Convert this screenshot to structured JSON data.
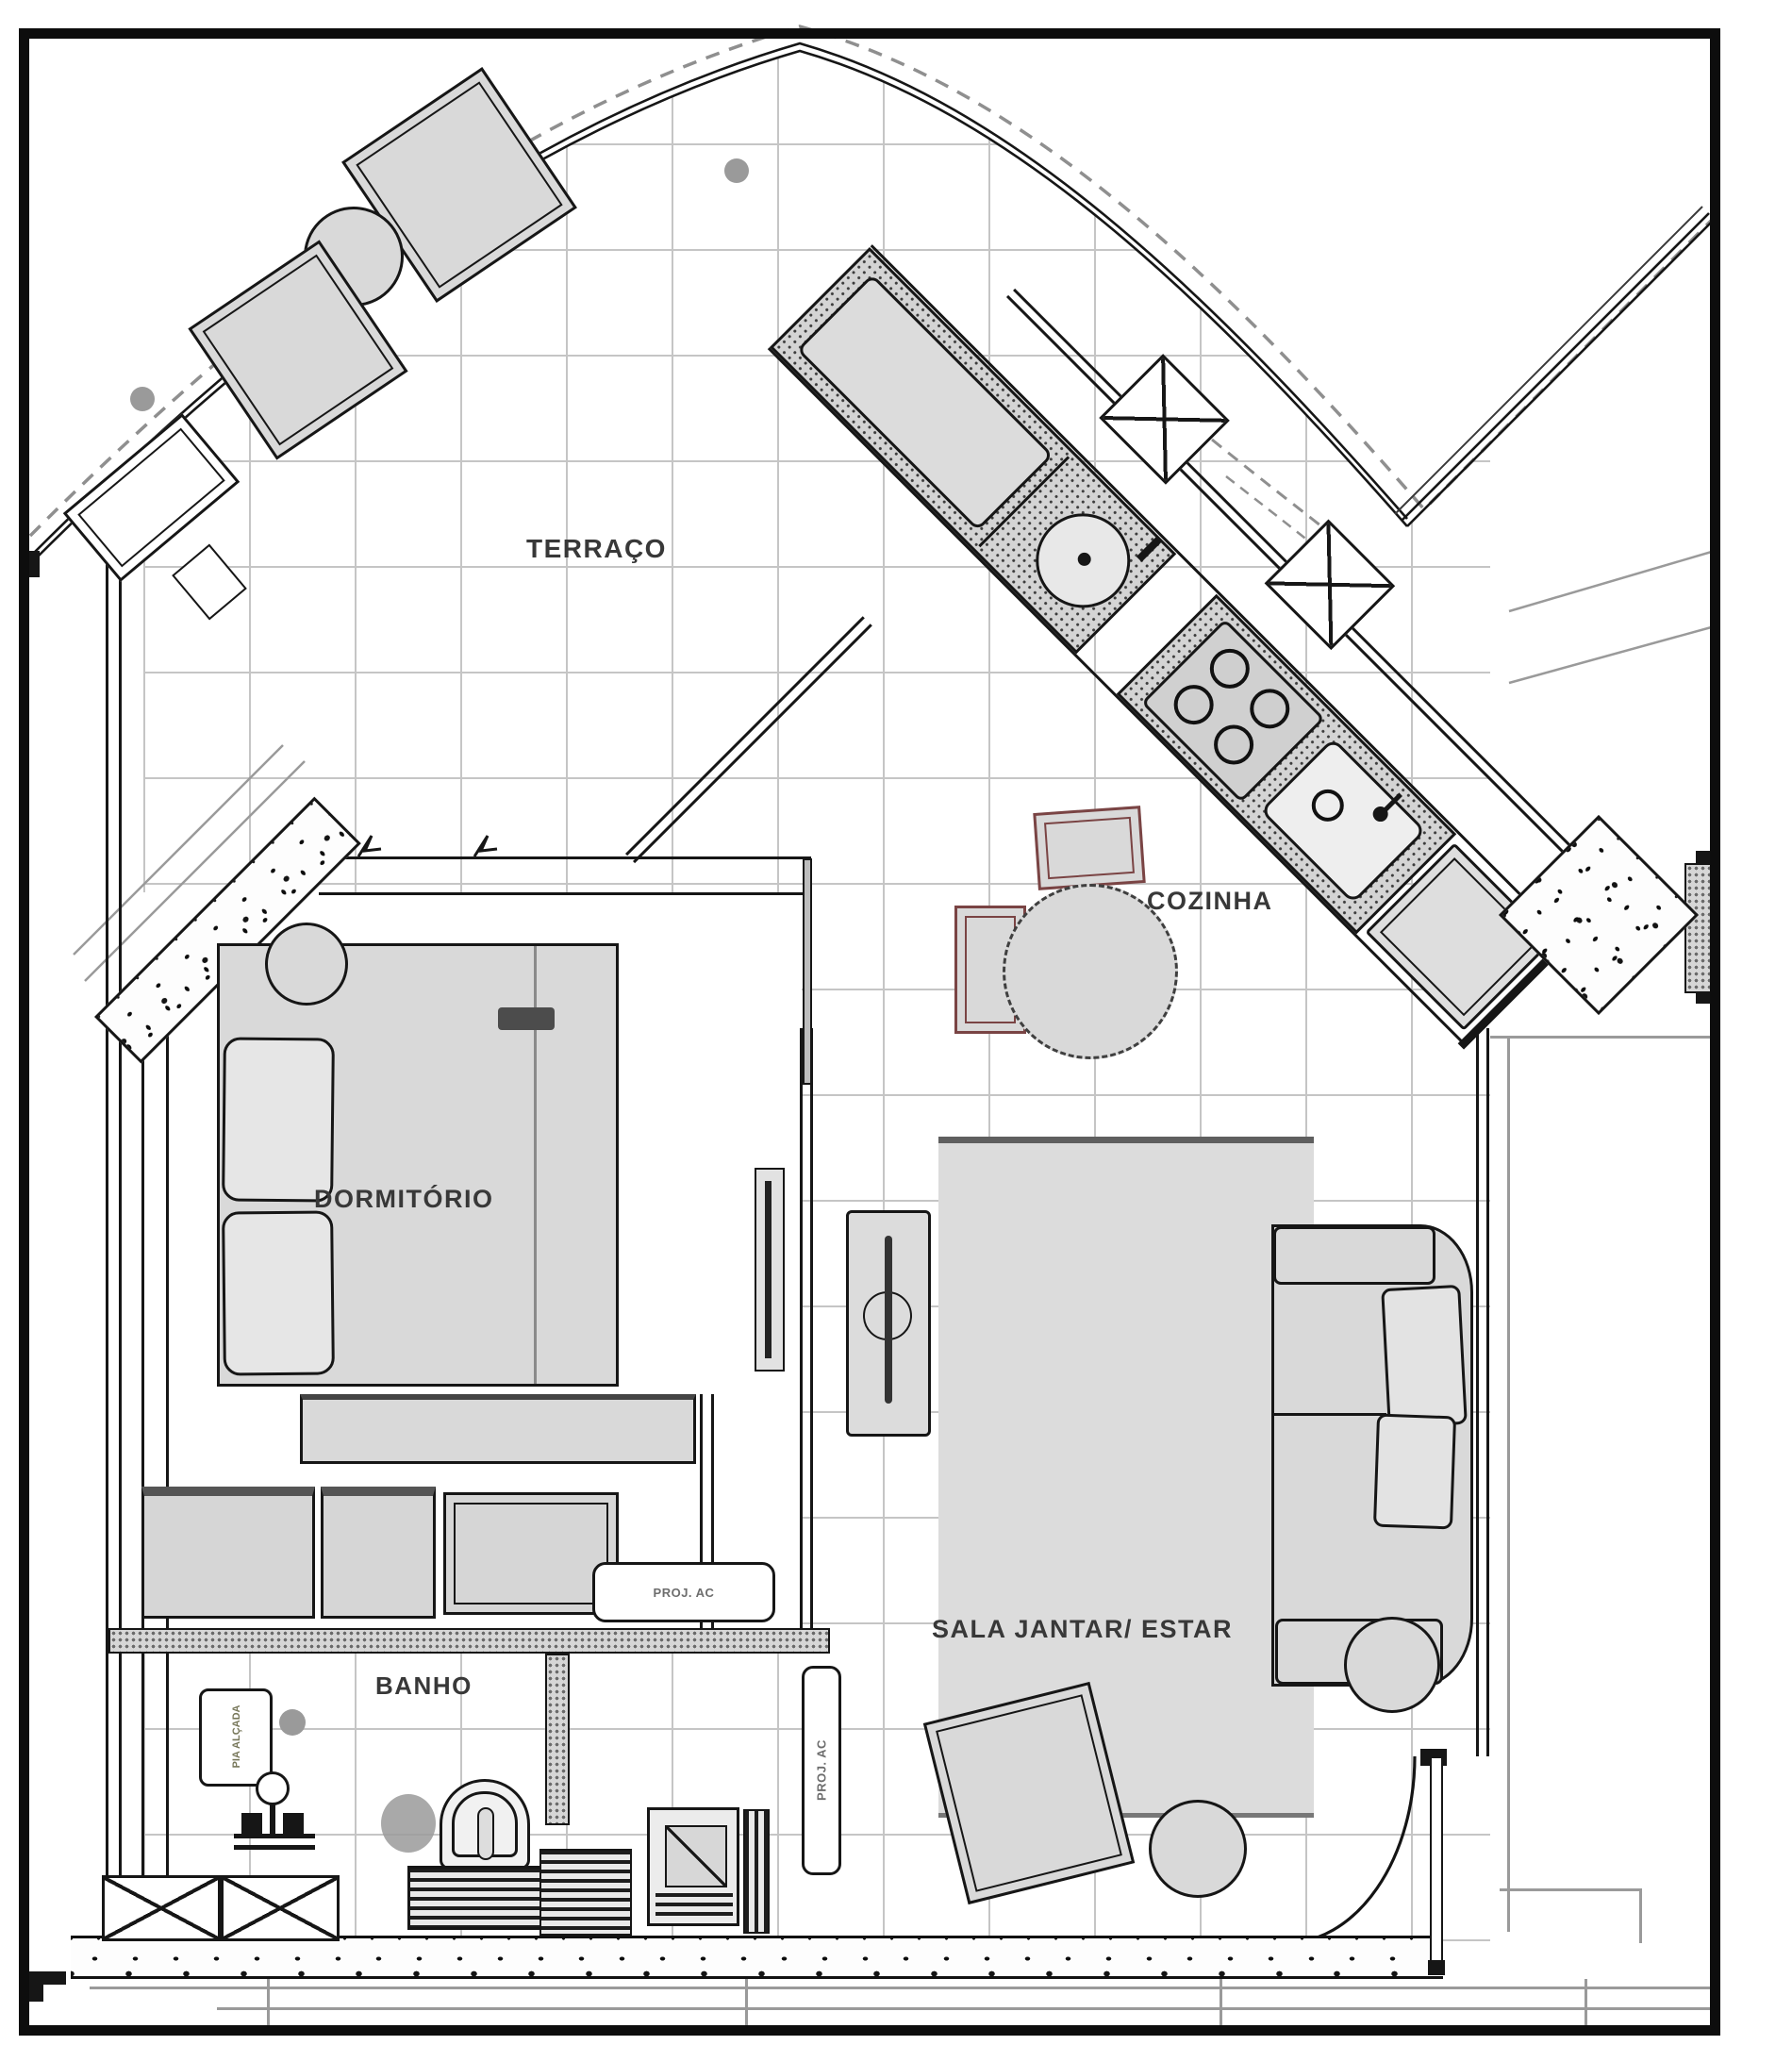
{
  "document": {
    "type": "apartment floor plan drawing"
  },
  "rooms": {
    "terrace": {
      "label": "TERRAÇO"
    },
    "kitchen": {
      "label": "COZINHA"
    },
    "bedroom": {
      "label": "DORMITÓRIO"
    },
    "living": {
      "label": "SALA JANTAR/ ESTAR"
    },
    "bathroom": {
      "label": "BANHO"
    }
  },
  "annotations": {
    "ac_projection_top": "PROJ. AC",
    "ac_projection_side": "PROJ. AC",
    "raised_sink_note": "PIA ALÇADA"
  },
  "colors": {
    "line": "#161616",
    "furniture_fill": "#d9d9d9",
    "grid": "#c5c5c5",
    "chair_accent": "#7a4444",
    "column_dot": "#9a9a9a",
    "counter_stipple": "#d4d4d4"
  }
}
